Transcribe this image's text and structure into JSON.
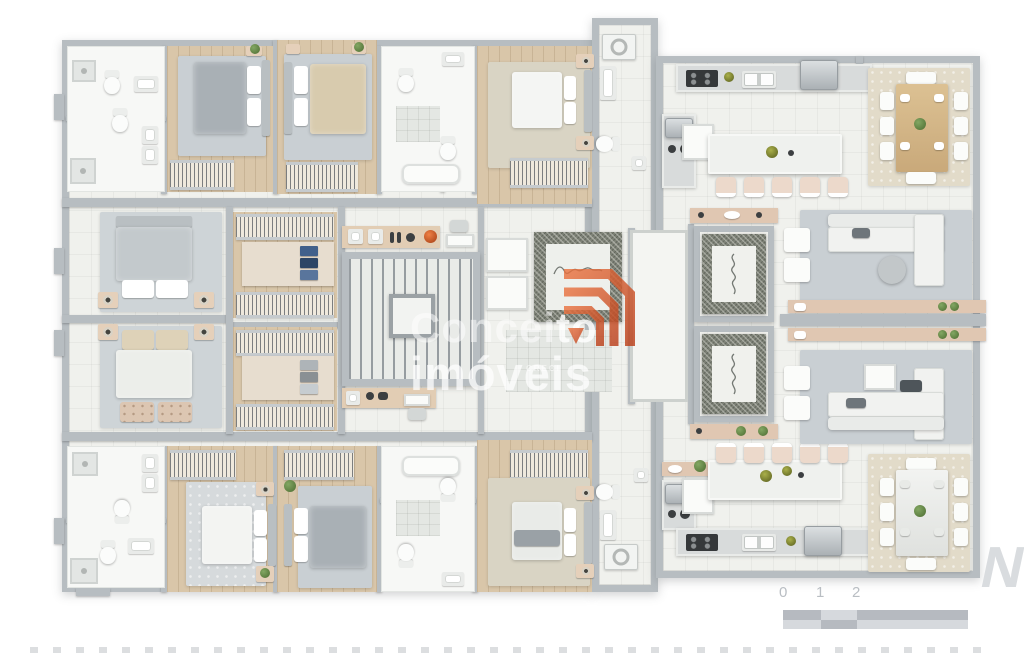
{
  "image": {
    "description": "3D rendered residential floor plan, top view, two mirrored apartments around a central elevator and stair core",
    "background": "#ffffff"
  },
  "watermark": {
    "brand_light": "Concei",
    "brand_bold": "to",
    "brand_line2": "imóveis",
    "subtext": "CRECI"
  },
  "scale_bar": {
    "labels": [
      "0",
      "1",
      "2",
      "5"
    ]
  },
  "compass": {
    "letter": "N"
  },
  "colors": {
    "wall": "#b7bdc1",
    "tile": "#f0f1ed",
    "wood": "#d9c6a9",
    "counter": "#d8dbdb",
    "island": "#eff1ee",
    "tan": "#e0c7b2",
    "marble": "#7d8176",
    "ruggray": "#c9cfd3",
    "rugbeige": "#e2dbc9",
    "duvetgray": "#a9b0b5",
    "duvetbeige": "#d8cbae",
    "steel": "#c2c7ca",
    "green": "#5d7c3d",
    "orange": "#d9552b",
    "scaledark": "#b6bac0",
    "scalelight": "#d6d9dd",
    "labelgray": "#b9bec3"
  }
}
